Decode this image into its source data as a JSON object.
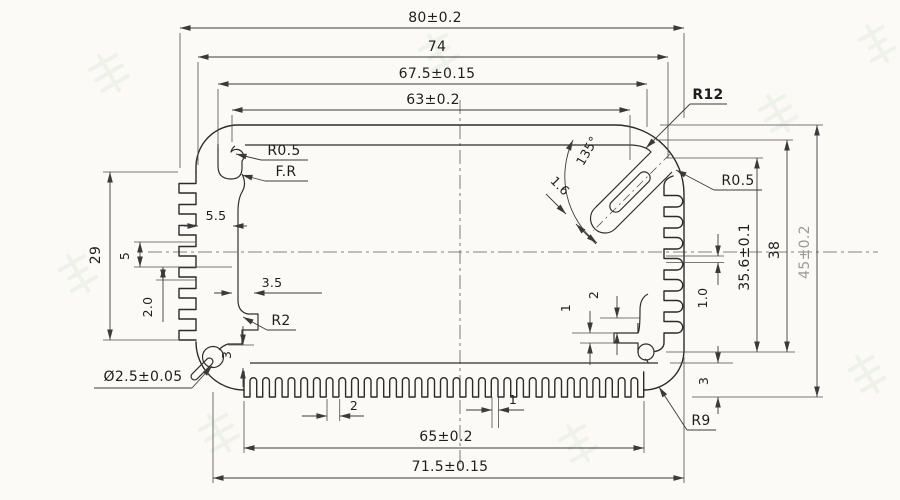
{
  "colors": {
    "ink": "#2b2b2b",
    "paper": "#fbfaf6",
    "faded_dim": "#9a9a9a",
    "watermark": "#6f9c84"
  },
  "dims": {
    "top": {
      "overall": "80±0.2",
      "outer": "74",
      "mid": "67.5±0.15",
      "inner": "63±0.2"
    },
    "bottom": {
      "fin_span": "65±0.2",
      "base": "71.5±0.15",
      "fin_pitch": "2",
      "fin_width": "1"
    },
    "right": {
      "inner_h": "35.6±0.1",
      "mid_h": "38",
      "overall_h": "45±0.2",
      "fin_gap": "1.0",
      "fin_h": "3",
      "step1": "1",
      "step2": "2",
      "slot_w": "1.6",
      "angle": "135°"
    },
    "left": {
      "fin_zone": "29",
      "pitch": "5",
      "gap": "2.0",
      "depth": "5.5",
      "step": "3.5",
      "step_h": "3",
      "hole": "Ø2.5±0.05"
    }
  },
  "labels": {
    "r12": "R12",
    "r05_right": "R0.5",
    "r05_left": "R0.5",
    "fr": "F.R",
    "r2": "R2",
    "r9": "R9"
  }
}
